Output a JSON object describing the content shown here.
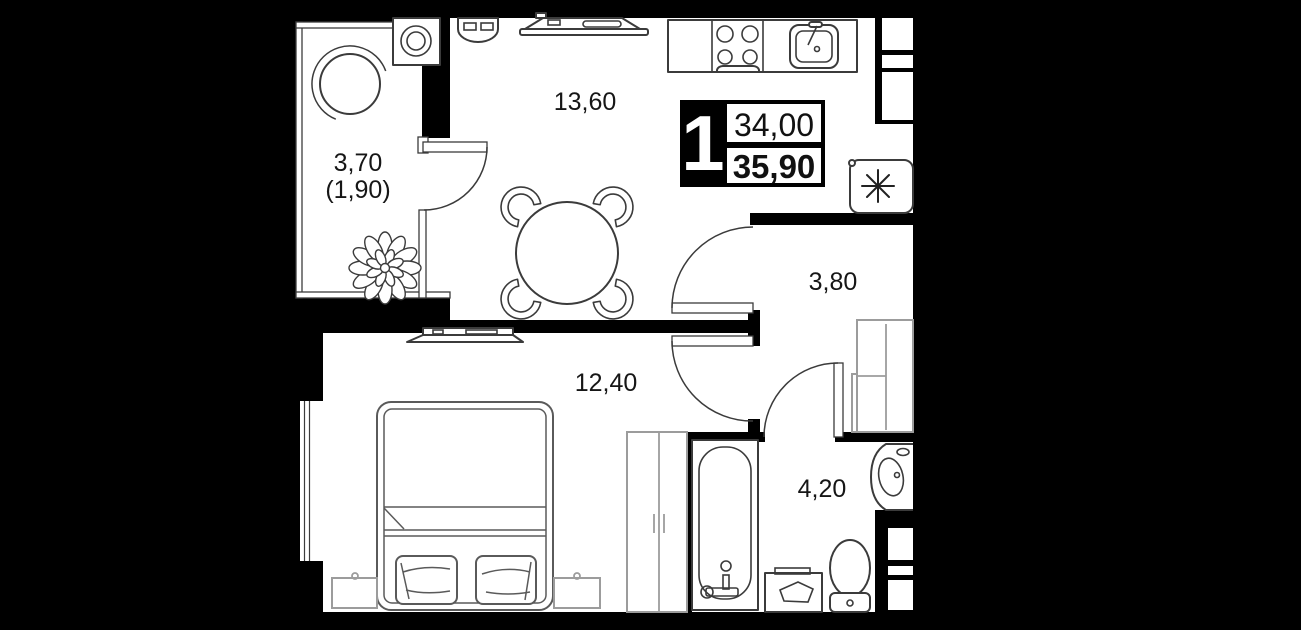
{
  "badge": {
    "rooms_count": "1",
    "area_living": "34,00",
    "area_total": "35,90"
  },
  "rooms": {
    "living_kitchen": {
      "area_label": "13,60"
    },
    "bedroom": {
      "area_label": "12,40"
    },
    "bathroom": {
      "area_label": "4,20"
    },
    "hallway": {
      "area_label": "3,80"
    },
    "balcony": {
      "area_label": "3,70",
      "area_label_secondary": "(1,90)"
    }
  },
  "icons": {
    "utility_marker": "asterisk-8-spoke"
  },
  "colors": {
    "background": "#000000",
    "wall": "#000000",
    "floor": "#ffffff",
    "line_dark": "#3b3b3b",
    "line_gray": "#9c9c9c",
    "text": "#161616"
  }
}
